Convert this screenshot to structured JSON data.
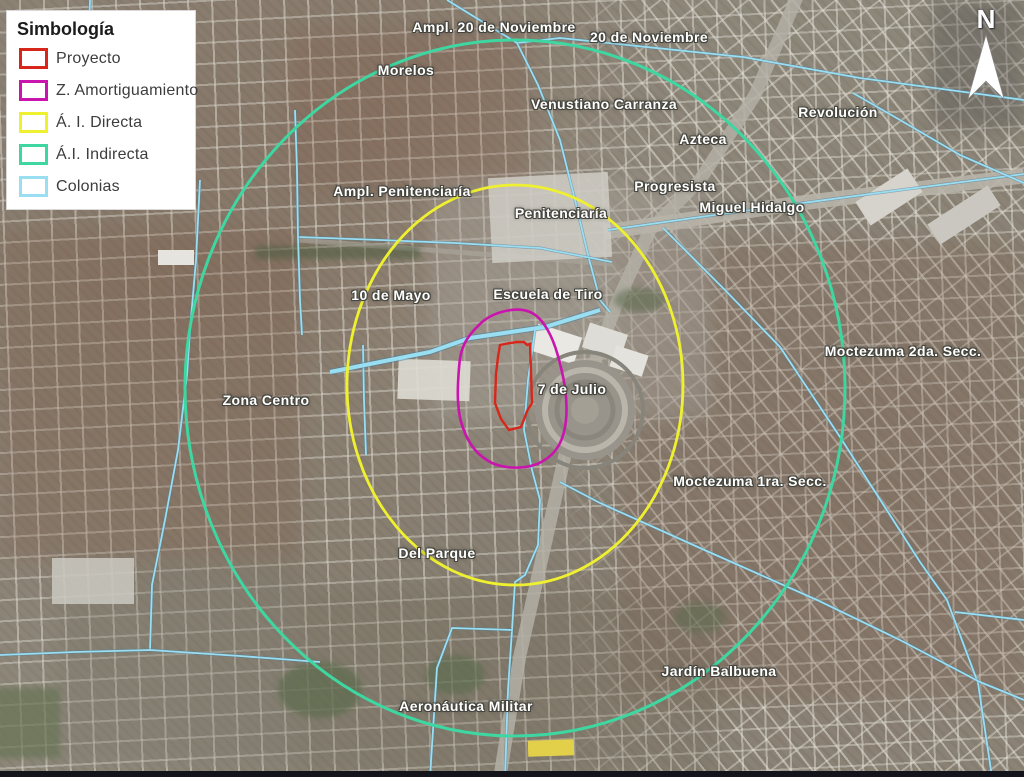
{
  "legend": {
    "title": "Simbología",
    "items": [
      {
        "id": "proyecto",
        "label": "Proyecto",
        "color": "#d7261a"
      },
      {
        "id": "amortiguamiento",
        "label": "Z. Amortiguamiento",
        "color": "#c915ae"
      },
      {
        "id": "directa",
        "label": "Á. I. Directa",
        "color": "#eff02f"
      },
      {
        "id": "indirecta",
        "label": "Á.I. Indirecta",
        "color": "#3ed6a1"
      },
      {
        "id": "colonias",
        "label": "Colonias",
        "color": "#9adef2"
      }
    ]
  },
  "overlay_colors": {
    "proyecto": "#d7261a",
    "amortiguamiento": "#c915ae",
    "directa": "#eff02f",
    "indirecta": "#3ed6a1",
    "colonias": "#9adef2"
  },
  "north": {
    "label": "N"
  },
  "map": {
    "labels": [
      {
        "id": "ampl-20-de-noviembre",
        "text": "Ampl. 20 de Noviembre",
        "x": 494,
        "y": 27
      },
      {
        "id": "20-de-noviembre",
        "text": "20 de Noviembre",
        "x": 649,
        "y": 37
      },
      {
        "id": "morelos",
        "text": "Morelos",
        "x": 406,
        "y": 70
      },
      {
        "id": "venustiano-carranza",
        "text": "Venustiano Carranza",
        "x": 604,
        "y": 104
      },
      {
        "id": "revolucion",
        "text": "Revolución",
        "x": 838,
        "y": 112
      },
      {
        "id": "azteca",
        "text": "Azteca",
        "x": 703,
        "y": 139
      },
      {
        "id": "ampl-penitenciaria",
        "text": "Ampl. Penitenciaría",
        "x": 402,
        "y": 191
      },
      {
        "id": "progresista",
        "text": "Progresista",
        "x": 675,
        "y": 186
      },
      {
        "id": "penitenciaria",
        "text": "Penitenciaría",
        "x": 561,
        "y": 213
      },
      {
        "id": "miguel-hidalgo",
        "text": "Miguel Hidalgo",
        "x": 752,
        "y": 207
      },
      {
        "id": "10-de-mayo",
        "text": "10 de Mayo",
        "x": 391,
        "y": 295
      },
      {
        "id": "escuela-de-tiro",
        "text": "Escuela de Tiro",
        "x": 548,
        "y": 294
      },
      {
        "id": "moctezuma-2da-secc",
        "text": "Moctezuma 2da. Secc.",
        "x": 903,
        "y": 351
      },
      {
        "id": "zona-centro",
        "text": "Zona Centro",
        "x": 266,
        "y": 400
      },
      {
        "id": "7-de-julio",
        "text": "7 de Julio",
        "x": 572,
        "y": 389
      },
      {
        "id": "moctezuma-1ra-secc",
        "text": "Moctezuma 1ra. Secc.",
        "x": 750,
        "y": 481
      },
      {
        "id": "del-parque",
        "text": "Del Parque",
        "x": 437,
        "y": 553
      },
      {
        "id": "jardin-balbuena",
        "text": "Jardín Balbuena",
        "x": 719,
        "y": 671
      },
      {
        "id": "aeronautica-militar",
        "text": "Aeronáutica Militar",
        "x": 466,
        "y": 706
      }
    ]
  }
}
